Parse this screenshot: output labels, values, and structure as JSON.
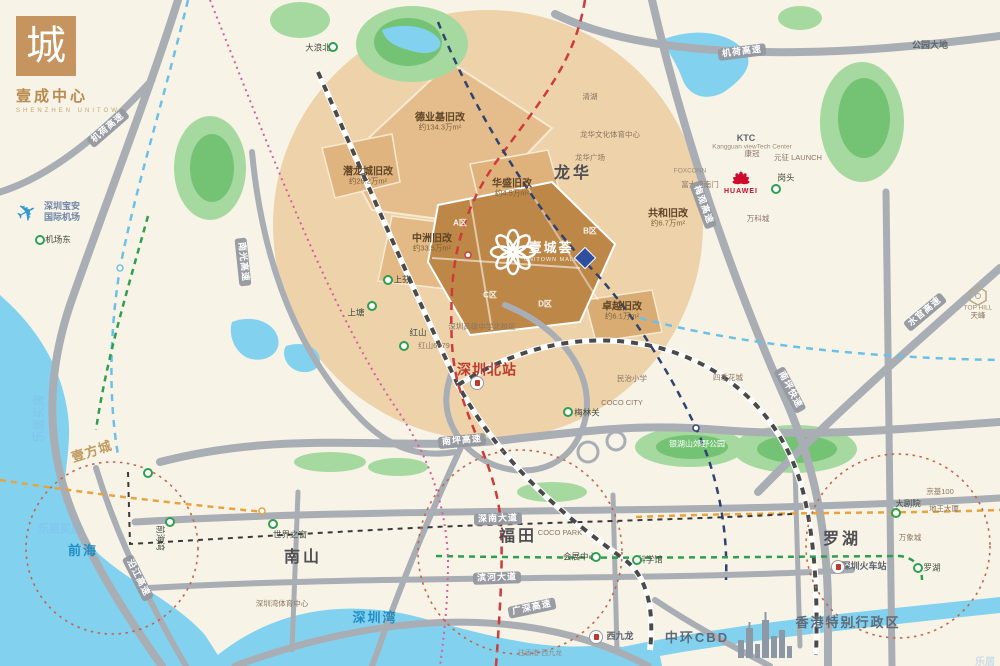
{
  "brand": {
    "glyph": "城",
    "title": "壹成中心",
    "subtitle": "SHENZHEN UNITOWN"
  },
  "project": {
    "name": "壹城荟",
    "sub": "UNITOWN MALL"
  },
  "plane_glyph": "✈",
  "renewals": [
    {
      "name": "德业基旧改",
      "area": "约134.3万m²",
      "x": 440,
      "y": 122
    },
    {
      "name": "潜龙城旧改",
      "area": "约26.2万m²",
      "x": 368,
      "y": 176
    },
    {
      "name": "中洲旧改",
      "area": "约33.5万m²",
      "x": 432,
      "y": 243
    },
    {
      "name": "华盛旧改",
      "area": "约4.5万m²",
      "x": 512,
      "y": 188
    },
    {
      "name": "共和旧改",
      "area": "约6.7万m²",
      "x": 668,
      "y": 218
    },
    {
      "name": "卓越旧改",
      "area": "约6.1万m²",
      "x": 622,
      "y": 311
    }
  ],
  "labels": [
    {
      "text": "龙华",
      "x": 573,
      "y": 174,
      "cls": "district"
    },
    {
      "text": "南山",
      "x": 303,
      "y": 558,
      "cls": "district"
    },
    {
      "text": "福田",
      "x": 518,
      "y": 537,
      "cls": "district"
    },
    {
      "text": "罗湖",
      "x": 842,
      "y": 540,
      "cls": "district"
    },
    {
      "text": "前海",
      "x": 83,
      "y": 551,
      "cls": "water-big"
    },
    {
      "text": "深圳湾",
      "x": 375,
      "y": 618,
      "cls": "water-big"
    },
    {
      "text": "香港特别行政区",
      "x": 848,
      "y": 623,
      "cls": "district-sm"
    },
    {
      "text": "中环CBD",
      "x": 697,
      "y": 638,
      "cls": "district-sm"
    },
    {
      "text": "西九龙",
      "x": 620,
      "y": 637,
      "cls": "minor-dark"
    },
    {
      "text": "深圳北站",
      "x": 487,
      "y": 370,
      "cls": "red-big"
    },
    {
      "text": "壹方城",
      "x": 92,
      "y": 452,
      "cls": "script",
      "rot": -18
    },
    {
      "text": "公园大地",
      "x": 930,
      "y": 46,
      "cls": "minor-dark"
    },
    {
      "text": "COCO CITY",
      "x": 622,
      "y": 403,
      "cls": "minor"
    },
    {
      "text": "COCO PARK",
      "x": 560,
      "y": 533,
      "cls": "minor"
    },
    {
      "text": "世界之窗",
      "x": 290,
      "y": 535,
      "cls": "station-label"
    },
    {
      "text": "会展中心",
      "x": 580,
      "y": 557,
      "cls": "station-label"
    },
    {
      "text": "科学馆",
      "x": 650,
      "y": 560,
      "cls": "station-label"
    },
    {
      "text": "大剧院",
      "x": 908,
      "y": 504,
      "cls": "station-label"
    },
    {
      "text": "罗湖",
      "x": 932,
      "y": 568,
      "cls": "station-label"
    },
    {
      "text": "深圳火车站",
      "x": 864,
      "y": 567,
      "cls": "minor-dark"
    },
    {
      "text": "京基100",
      "x": 940,
      "y": 492,
      "cls": "minor"
    },
    {
      "text": "地王大厦",
      "x": 944,
      "y": 509,
      "cls": "minor"
    },
    {
      "text": "万象城",
      "x": 910,
      "y": 538,
      "cls": "minor"
    },
    {
      "text": "深圳湾体育中心",
      "x": 282,
      "y": 604,
      "cls": "minor"
    },
    {
      "text": "梅林关",
      "x": 587,
      "y": 413,
      "cls": "station-label"
    },
    {
      "text": "民治小学",
      "x": 632,
      "y": 379,
      "cls": "minor"
    },
    {
      "text": "四季花城",
      "x": 728,
      "y": 378,
      "cls": "minor"
    },
    {
      "text": "银湖山郊野公园",
      "x": 697,
      "y": 445,
      "cls": "park"
    },
    {
      "text": "KTC",
      "x": 746,
      "y": 139,
      "cls": "minor-dark"
    },
    {
      "text": "Kangguan viewTech Center",
      "x": 752,
      "y": 147,
      "cls": "minor-en"
    },
    {
      "text": "康冠",
      "x": 752,
      "y": 154,
      "cls": "minor"
    },
    {
      "text": "元征 LAUNCH",
      "x": 798,
      "y": 158,
      "cls": "minor"
    },
    {
      "text": "HUAWEI",
      "x": 741,
      "y": 192,
      "cls": "huawei"
    },
    {
      "text": "岗头",
      "x": 786,
      "y": 178,
      "cls": "station-label"
    },
    {
      "text": "FOXCONN",
      "x": 690,
      "y": 171,
      "cls": "minor-en"
    },
    {
      "text": "富士康南门",
      "x": 700,
      "y": 185,
      "cls": "minor"
    },
    {
      "text": "万科城",
      "x": 758,
      "y": 219,
      "cls": "minor"
    },
    {
      "text": "清湖",
      "x": 590,
      "y": 97,
      "cls": "minor"
    },
    {
      "text": "龙华文化体育中心",
      "x": 610,
      "y": 135,
      "cls": "minor"
    },
    {
      "text": "龙华广场",
      "x": 590,
      "y": 158,
      "cls": "minor"
    },
    {
      "text": "大浪北",
      "x": 318,
      "y": 48,
      "cls": "station-label"
    },
    {
      "text": "机场东",
      "x": 58,
      "y": 240,
      "cls": "station-label"
    },
    {
      "text": "深圳宝安",
      "x": 62,
      "y": 207,
      "cls": "airport"
    },
    {
      "text": "国际机场",
      "x": 62,
      "y": 218,
      "cls": "airport"
    },
    {
      "text": "上芬",
      "x": 402,
      "y": 280,
      "cls": "station-label"
    },
    {
      "text": "上塘",
      "x": 356,
      "y": 313,
      "cls": "station-label"
    },
    {
      "text": "红山",
      "x": 418,
      "y": 333,
      "cls": "station-label"
    },
    {
      "text": "红山6979",
      "x": 434,
      "y": 346,
      "cls": "minor"
    },
    {
      "text": "深圳高级中学北校区",
      "x": 482,
      "y": 327,
      "cls": "minor"
    },
    {
      "text": "前海湾",
      "x": 160,
      "y": 538,
      "cls": "station-label",
      "rot": 90
    },
    {
      "text": "往香港·西九龙",
      "x": 540,
      "y": 654,
      "cls": "tiny"
    },
    {
      "text": "TOP HILL",
      "x": 978,
      "y": 308,
      "cls": "minor-en"
    },
    {
      "text": "天峰",
      "x": 978,
      "y": 316,
      "cls": "minor"
    },
    {
      "text": "A区",
      "x": 460,
      "y": 224,
      "cls": "zone"
    },
    {
      "text": "B区",
      "x": 590,
      "y": 232,
      "cls": "zone"
    },
    {
      "text": "C区",
      "x": 490,
      "y": 296,
      "cls": "zone"
    },
    {
      "text": "D区",
      "x": 545,
      "y": 305,
      "cls": "zone"
    }
  ],
  "road_labels": [
    {
      "text": "机荷高速",
      "x": 108,
      "y": 128,
      "rot": -41
    },
    {
      "text": "机荷高速",
      "x": 742,
      "y": 52,
      "rot": -7
    },
    {
      "text": "梅观高速",
      "x": 703,
      "y": 205,
      "rot": 70
    },
    {
      "text": "南光高速",
      "x": 243,
      "y": 262,
      "rot": 84
    },
    {
      "text": "南坪高速",
      "x": 462,
      "y": 441,
      "rot": -5
    },
    {
      "text": "南坪快速",
      "x": 790,
      "y": 390,
      "rot": 62
    },
    {
      "text": "水官高速",
      "x": 925,
      "y": 312,
      "rot": -40
    },
    {
      "text": "深南大道",
      "x": 498,
      "y": 519,
      "rot": -2
    },
    {
      "text": "滨河大道",
      "x": 497,
      "y": 578,
      "rot": -2
    },
    {
      "text": "广深高速",
      "x": 532,
      "y": 608,
      "rot": -12
    },
    {
      "text": "沿江高速",
      "x": 138,
      "y": 578,
      "rot": 63
    }
  ],
  "stations": [
    {
      "x": 333,
      "y": 47
    },
    {
      "x": 40,
      "y": 240
    },
    {
      "x": 388,
      "y": 280
    },
    {
      "x": 372,
      "y": 306
    },
    {
      "x": 404,
      "y": 346
    },
    {
      "x": 568,
      "y": 412
    },
    {
      "x": 776,
      "y": 189
    },
    {
      "x": 273,
      "y": 524
    },
    {
      "x": 596,
      "y": 557
    },
    {
      "x": 637,
      "y": 560
    },
    {
      "x": 896,
      "y": 513
    },
    {
      "x": 918,
      "y": 568
    },
    {
      "x": 148,
      "y": 473
    },
    {
      "x": 170,
      "y": 522
    }
  ],
  "rail_stations": [
    {
      "x": 477,
      "y": 383
    },
    {
      "x": 838,
      "y": 567
    },
    {
      "x": 596,
      "y": 637
    }
  ],
  "diamond": {
    "x": 585,
    "y": 258
  },
  "watermarks": [
    {
      "text": "乐居买房",
      "x": 14,
      "y": 410,
      "rot": -90,
      "size": 12
    },
    {
      "text": "乐居买房",
      "x": 38,
      "y": 520,
      "rot": 0,
      "size": 11
    },
    {
      "text": "乐居",
      "x": 975,
      "y": 653,
      "rot": 0,
      "size": 10
    }
  ],
  "colors": {
    "bg": "#f8f3e7",
    "water": "#82d2ef",
    "park": "#a5d9a0",
    "park_dark": "#74c374",
    "road": "#a9adb4",
    "focus_circle": "#ecd0a6",
    "parcel": "#e3ba86",
    "project": "#c08b52",
    "metro_red": "#cf3a3a",
    "metro_navy": "#2e4372",
    "metro_sky": "#6cc0e8",
    "metro_green": "#2e9e4f",
    "metro_orange": "#e8a33d",
    "metro_magenta": "#d45fa0",
    "ring": "#c3654a",
    "huawei_red": "#cf0a2c",
    "diamond_blue": "#2f4f9e",
    "brand_tan": "#c5945f"
  }
}
